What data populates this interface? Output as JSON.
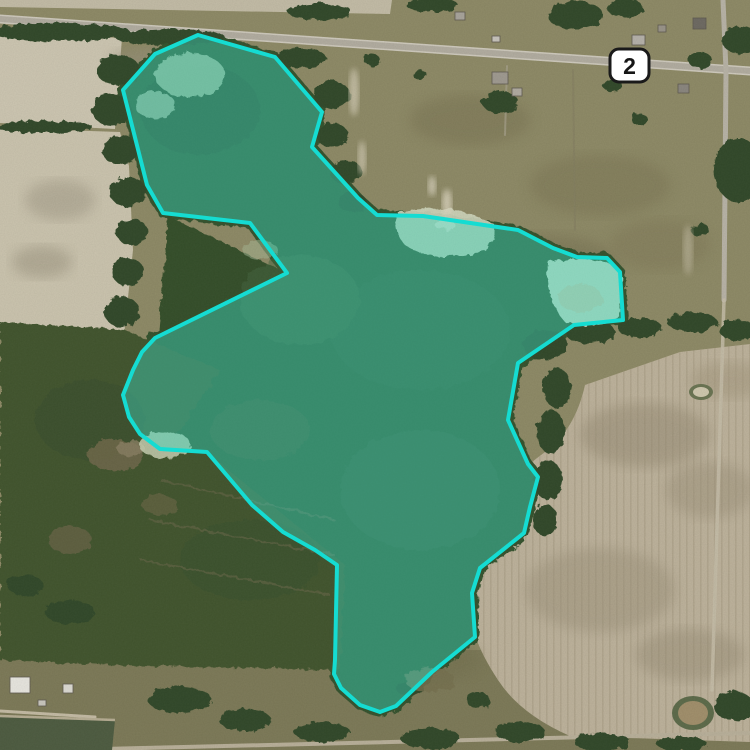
{
  "map": {
    "type": "satellite-aerial-view",
    "route_shield": {
      "number": "2"
    },
    "overlay": {
      "points": "198,35 275,57 322,112 312,147 358,198 377,215 423,216 518,230 553,248 577,257 607,258 620,272 623,320 574,325 518,363 508,420 528,464 538,477 530,507 524,533 480,568 472,593 475,637 432,672 396,706 380,712 360,705 341,688 334,674 335,660 337,565 315,550 283,532 252,505 207,452 160,449 140,434 129,417 123,395 133,370 142,352 155,338 287,273 250,223 163,213 147,185 123,90 155,54",
      "stroke_color": "#15dcd2",
      "fill_color": "rgba(61,220,196,0.42)"
    }
  }
}
